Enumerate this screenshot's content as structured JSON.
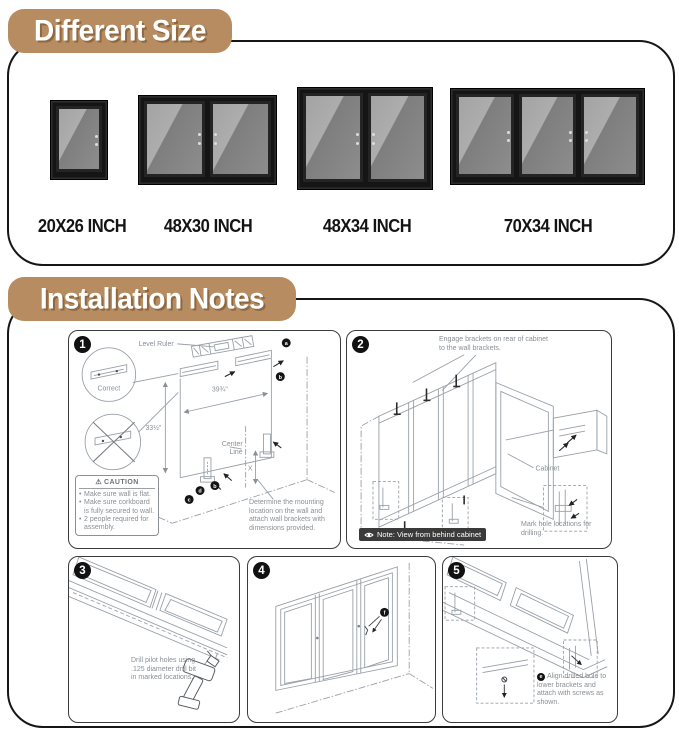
{
  "colors": {
    "accent_tan": "#b78c60",
    "note_badge_bg": "#3a3a3a",
    "diagram_line": "#8a9096"
  },
  "different_size": {
    "title": "Different Size",
    "products": [
      {
        "label": "20X26 INCH",
        "doors": 1
      },
      {
        "label": "48X30 INCH",
        "doors": 2
      },
      {
        "label": "48X34 INCH",
        "doors": 2
      },
      {
        "label": "70X34 INCH",
        "doors": 3
      }
    ]
  },
  "installation": {
    "title": "Installation Notes",
    "step1": {
      "number": "1",
      "level_ruler": "Level Ruler",
      "correct": "Correct",
      "dim_width": "39¾\"",
      "dim_height": "33½\"",
      "center_line_top": "Center",
      "center_line_bottom": "Line",
      "dim_x": "X",
      "marker_a": "a",
      "marker_b": "b",
      "marker_c": "c",
      "marker_d": "d",
      "caution_icon": "⚠",
      "caution_title": "CAUTION",
      "caution_items": [
        "Make sure wall is flat.",
        "Make sure corkboard is fully secured to wall.",
        "2 people required for assembly."
      ],
      "note": "Determine the mounting location on the wall and attach wall brackets with dimensions provided."
    },
    "step2": {
      "number": "2",
      "engage": "Engage brackets on rear of cabinet to the wall brackets.",
      "cabinet_label": "Cabinet",
      "mark": "Mark hole locations for drilling.",
      "note": "Note: View from behind cabinet"
    },
    "step3": {
      "number": "3",
      "text": "Drill pilot holes using .125 diameter drill bit in marked locations."
    },
    "step4": {
      "number": "4",
      "marker": "f"
    },
    "step5": {
      "number": "5",
      "marker": "e",
      "text": "Align drilled hole to lower brackets and attach with screws as shown."
    }
  }
}
